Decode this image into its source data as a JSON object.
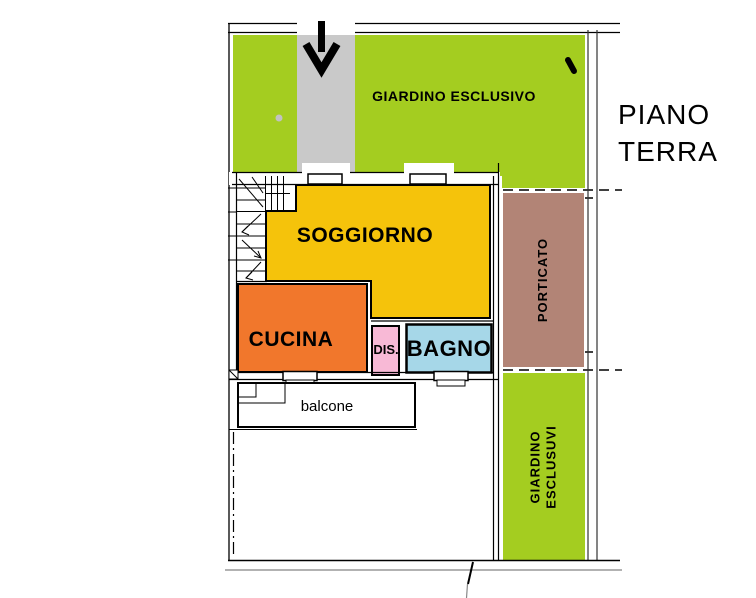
{
  "title": {
    "line1": "PIANO",
    "line2": "TERRA"
  },
  "plan": {
    "garden_top": {
      "label": "GIARDINO ESCLUSIVO",
      "color": "#a4cd20"
    },
    "garden_right": {
      "line1": "GIARDINO",
      "line2": "ESCLUSUVI",
      "color": "#a4cd20"
    },
    "soggiorno": {
      "label": "SOGGIORNO",
      "color": "#f5c30b"
    },
    "cucina": {
      "label": "CUCINA",
      "color": "#f1772c"
    },
    "dis": {
      "label": "DIS.",
      "color": "#f8b9d6"
    },
    "bagno": {
      "label": "BAGNO",
      "color": "#a6d7e8"
    },
    "porticato": {
      "label": "PORTICATO",
      "color": "#b28476"
    },
    "balcone": {
      "label": "balcone"
    },
    "walkway_color": "#c9c9c9",
    "line_color": "#000000"
  },
  "icons": {
    "entrance_arrow": "down-arrow",
    "gate_mark": "gate-tick"
  }
}
